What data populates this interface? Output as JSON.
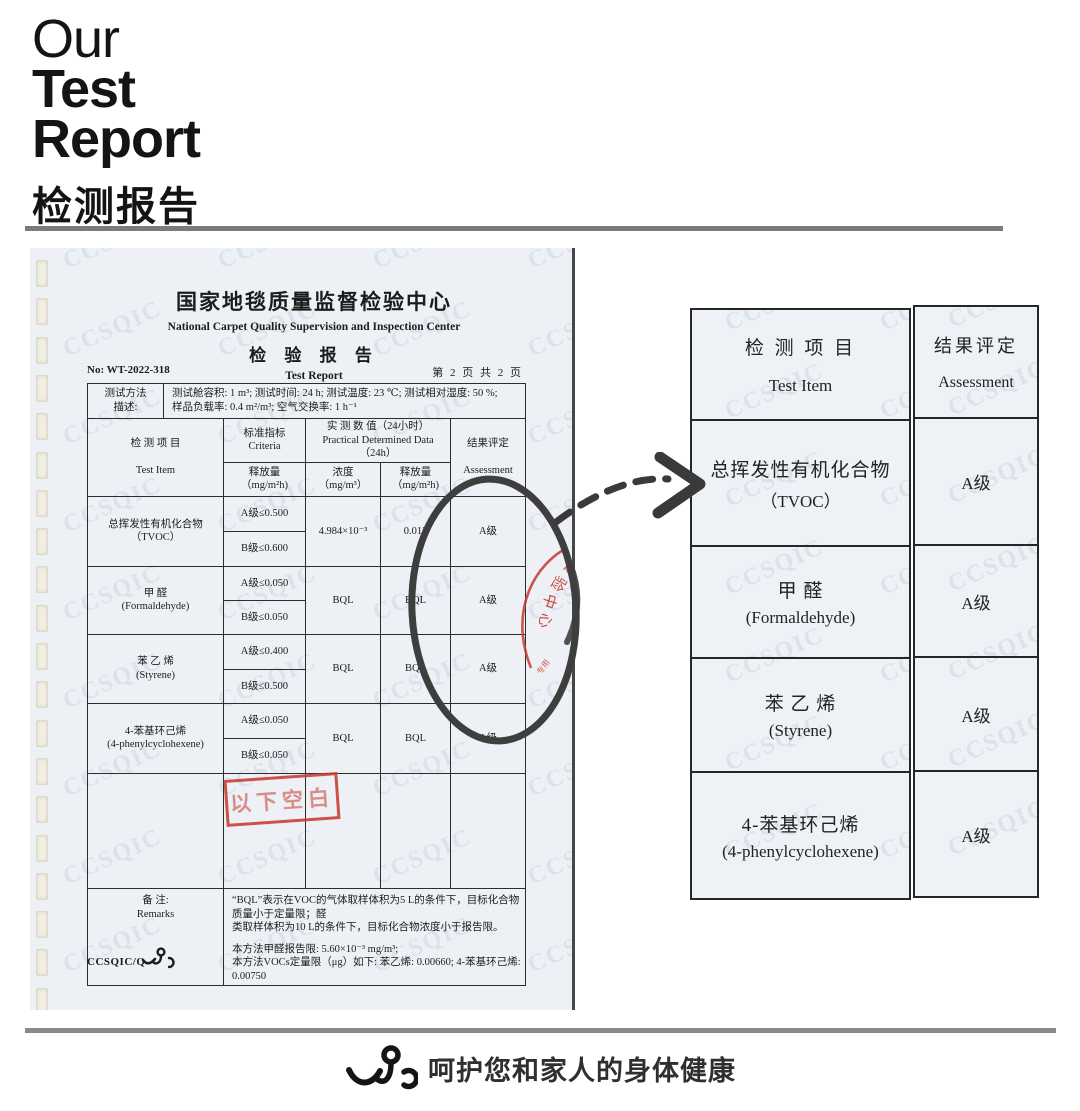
{
  "page_title": "检测报告",
  "header": {
    "word1": "Our",
    "word2": "Test",
    "word3": "Report",
    "subtitle_cn": "检测报告"
  },
  "colors": {
    "paper": "#edf1f6",
    "stamp_red": "#c23b31",
    "annotation_ink": "#3a3a3a",
    "divider_gray": "#7b7b7b"
  },
  "scan": {
    "watermark": "CCSQIC",
    "org_cn": "国家地毯质量监督检验中心",
    "org_en": "National Carpet Quality Supervision and Inspection Center",
    "title_cn": "检 验 报 告",
    "title_en": "Test Report",
    "report_no": "No: WT-2022-318",
    "page_info": "第 2 页 共 2 页",
    "method": {
      "label1": "测试方法",
      "label2": "描述:",
      "line1": "测试舱容积: 1 m³; 测试时间: 24 h; 测试温度: 23 ℃; 测试相对湿度: 50 %;",
      "line2": "样品负载率: 0.4 m²/m³; 空气交换率: 1 h⁻¹"
    },
    "table": {
      "h_item_cn": "检 测 项 目",
      "h_item_en": "Test Item",
      "h_criteria_cn": "标准指标",
      "h_criteria_en": "Criteria",
      "h_release": "释放量",
      "h_release_unit": "（mg/m²h)",
      "h_measured_cn": "实 测 数 值（24小时）",
      "h_measured_en": "Practical Determined Data（24h）",
      "h_conc": "浓度",
      "h_conc_unit": "（mg/m³）",
      "h_assess_cn": "结果评定",
      "h_assess_en": "Assessment",
      "rows": [
        {
          "cn": "总挥发性有机化合物",
          "en": "（TVOC）",
          "a": "A级≤0.500",
          "b": "B级≤0.600",
          "conc": "4.984×10⁻³",
          "rel": "0.012",
          "assess": "A级"
        },
        {
          "cn": "甲  醛",
          "en": "(Formaldehyde)",
          "a": "A级≤0.050",
          "b": "B级≤0.050",
          "conc": "BQL",
          "rel": "BQL",
          "assess": "A级"
        },
        {
          "cn": "苯 乙 烯",
          "en": "(Styrene)",
          "a": "A级≤0.400",
          "b": "B级≤0.500",
          "conc": "BQL",
          "rel": "BQL",
          "assess": "A级"
        },
        {
          "cn": "4-苯基环己烯",
          "en": "(4-phenylcyclohexene)",
          "a": "A级≤0.050",
          "b": "B级≤0.050",
          "conc": "BQL",
          "rel": "BQL",
          "assess": "A级"
        }
      ]
    },
    "blank_stamp": "以下空白",
    "seal_text": "检验中心",
    "remarks": {
      "label_cn": "备 注:",
      "label_en": "Remarks",
      "l1": "“BQL”表示在VOC的气体取样体积为5 L的条件下，目标化合物质量小于定量限；醛",
      "l2": "类取样体积为10 L的条件下，目标化合物浓度小于报告限。",
      "l3": "本方法甲醛报告限: 5.60×10⁻³ mg/m³;",
      "l4": "本方法VOCs定量限（μg）如下: 苯乙烯: 0.00660; 4-苯基环己烯: 0.00750"
    },
    "footer_code": "CCSQIC/Q"
  },
  "summary": {
    "h_item_cn": "检 测 项 目",
    "h_item_en": "Test Item",
    "h_assess_cn": "结果评定",
    "h_assess_en": "Assessment",
    "rows": [
      {
        "cn": "总挥发性有机化合物",
        "en": "（TVOC）",
        "assess": "A级"
      },
      {
        "cn": "甲  醛",
        "en": "(Formaldehyde)",
        "assess": "A级"
      },
      {
        "cn": "苯 乙 烯",
        "en": "(Styrene)",
        "assess": "A级"
      },
      {
        "cn": "4-苯基环己烯",
        "en": "(4-phenylcyclohexene)",
        "assess": "A级"
      }
    ]
  },
  "footer": {
    "slogan": "呵护您和家人的身体健康"
  }
}
